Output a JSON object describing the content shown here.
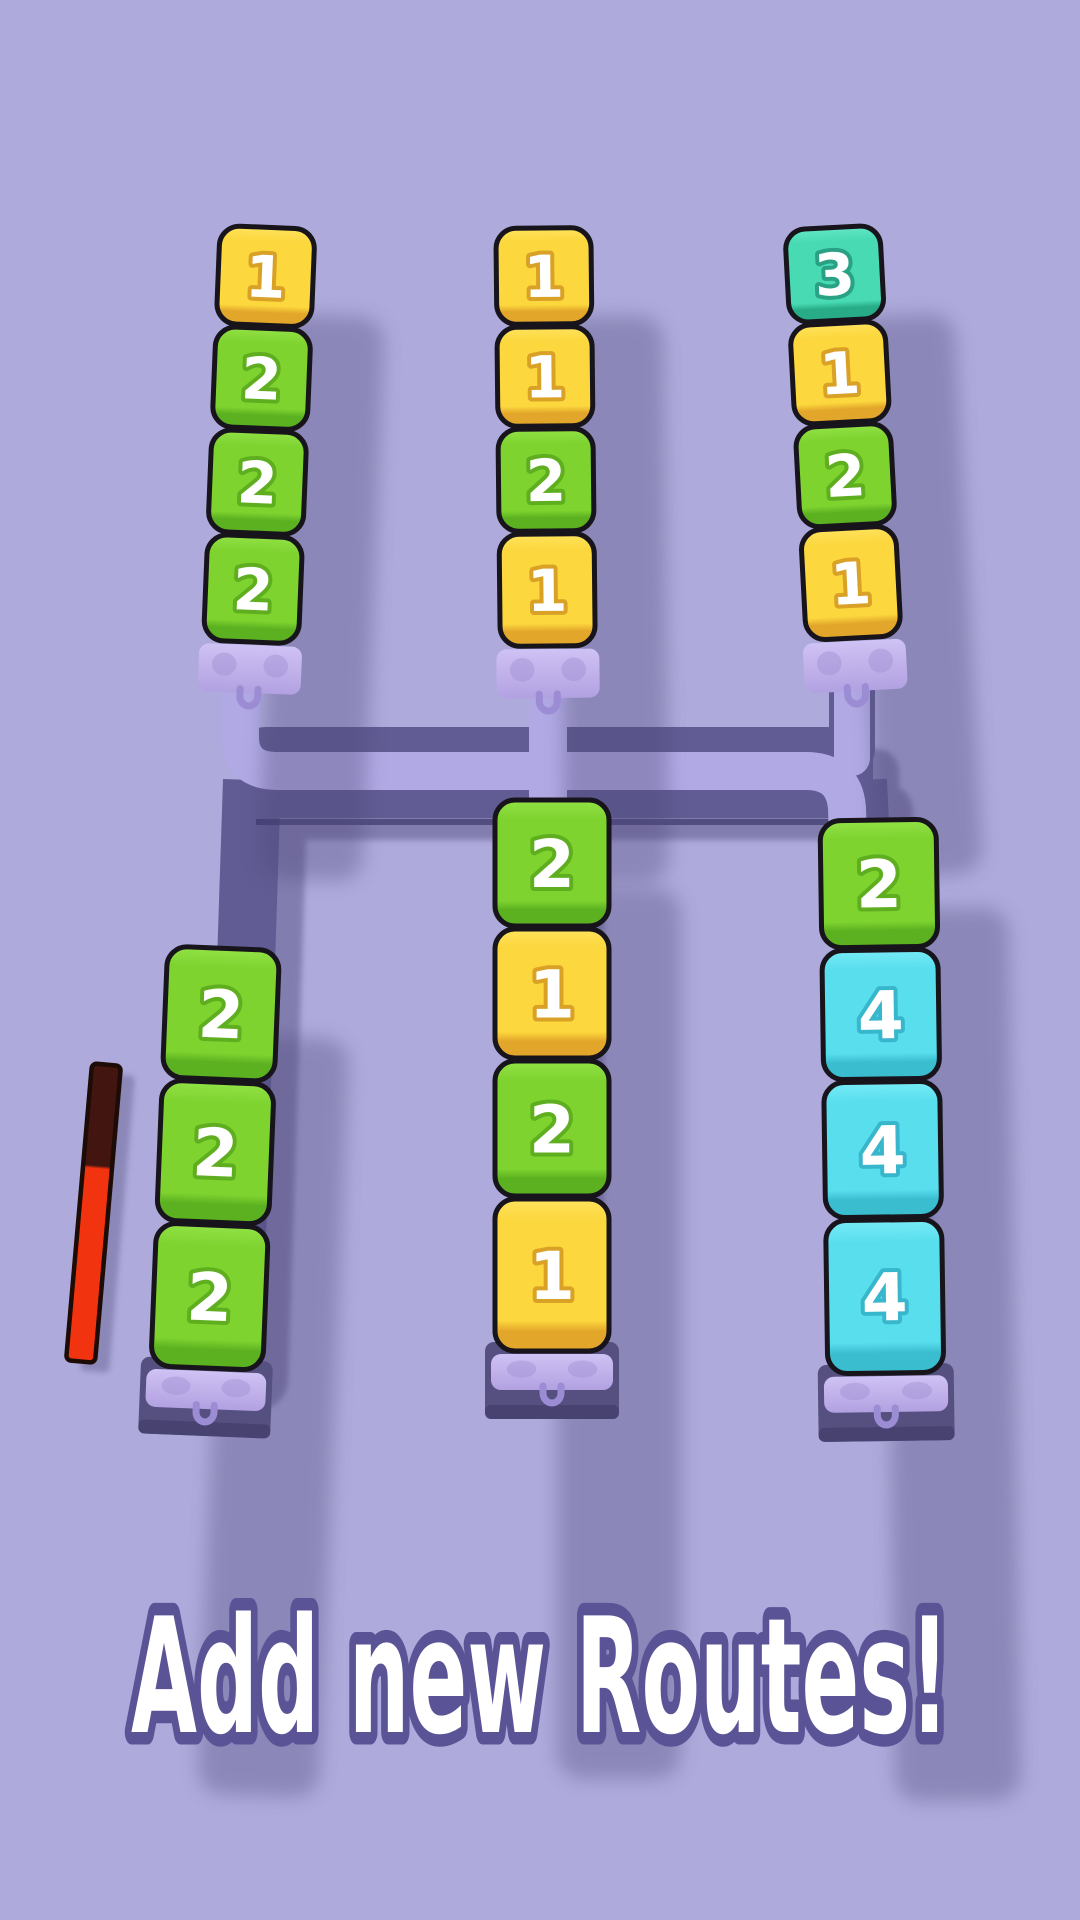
{
  "banner": {
    "text": "Add new Routes!",
    "fill": "#ffffff",
    "outline": "#5a5497"
  },
  "background": "#aeaadb",
  "route_colors": {
    "base": "#615c93",
    "highlight": "#b1a9e3",
    "shadow": "#5f5a8c",
    "underline": "#39346a",
    "terminal": "#55507f",
    "terminal_lip": "#47426f",
    "dock_top": "#cfc2f4",
    "dock_bottom": "#b2a1e1",
    "dock_spot": "#9f90d2",
    "dock_hook": "#9b8cd4",
    "floor_shadow": "#4b4677"
  },
  "block_palette": {
    "yellow": {
      "top": "#ffe35c",
      "mid": "#fcd73d",
      "dark": "#e2a62a",
      "number_outline": "#d9a126"
    },
    "green": {
      "top": "#92e246",
      "mid": "#7ed32f",
      "dark": "#5cb121",
      "number_outline": "#5fae1f"
    },
    "teal": {
      "top": "#62e7c6",
      "mid": "#48dab3",
      "dark": "#28ac87",
      "number_outline": "#2aa184"
    },
    "cyan": {
      "top": "#78ebf7",
      "mid": "#58deed",
      "dark": "#3bbdd0",
      "number_outline": "#38b6cc"
    }
  },
  "progress_bar": {
    "outline": "#1d0b06",
    "segments": [
      {
        "color": "#431510",
        "portion": 0.35
      },
      {
        "color": "#f2330f",
        "portion": 0.65
      }
    ]
  },
  "columns": [
    {
      "id": "top-left",
      "blocks": [
        {
          "value": "1",
          "color": "yellow"
        },
        {
          "value": "2",
          "color": "green"
        },
        {
          "value": "2",
          "color": "green"
        },
        {
          "value": "2",
          "color": "green"
        }
      ]
    },
    {
      "id": "top-middle",
      "blocks": [
        {
          "value": "1",
          "color": "yellow"
        },
        {
          "value": "1",
          "color": "yellow"
        },
        {
          "value": "2",
          "color": "green"
        },
        {
          "value": "1",
          "color": "yellow"
        }
      ]
    },
    {
      "id": "top-right",
      "blocks": [
        {
          "value": "3",
          "color": "teal"
        },
        {
          "value": "1",
          "color": "yellow"
        },
        {
          "value": "2",
          "color": "green"
        },
        {
          "value": "1",
          "color": "yellow"
        }
      ]
    },
    {
      "id": "bottom-left",
      "blocks": [
        {
          "value": "2",
          "color": "green"
        },
        {
          "value": "2",
          "color": "green"
        },
        {
          "value": "2",
          "color": "green"
        }
      ]
    },
    {
      "id": "bottom-middle",
      "blocks": [
        {
          "value": "2",
          "color": "green"
        },
        {
          "value": "1",
          "color": "yellow"
        },
        {
          "value": "2",
          "color": "green"
        },
        {
          "value": "1",
          "color": "yellow"
        }
      ]
    },
    {
      "id": "bottom-right",
      "blocks": [
        {
          "value": "2",
          "color": "green"
        },
        {
          "value": "4",
          "color": "cyan"
        },
        {
          "value": "4",
          "color": "cyan"
        },
        {
          "value": "4",
          "color": "cyan"
        }
      ]
    }
  ]
}
